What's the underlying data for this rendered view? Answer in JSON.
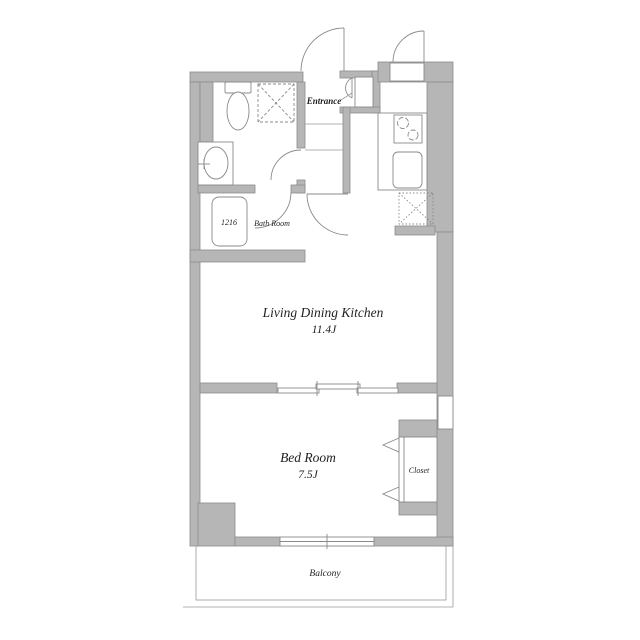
{
  "floorplan": {
    "rooms": {
      "entrance": {
        "label": "Entrance"
      },
      "bath": {
        "label": "Bath Room",
        "tub_label": "1216"
      },
      "ldk": {
        "label": "Living Dining Kitchen",
        "size": "11.4J"
      },
      "bedroom": {
        "label": "Bed Room",
        "size": "7.5J"
      },
      "closet": {
        "label": "Closet"
      },
      "balcony": {
        "label": "Balcony"
      }
    },
    "fixtures": [
      "toilet",
      "washing-machine-space",
      "washbasin",
      "bathtub",
      "stove",
      "kitchen-sink",
      "refrigerator-space",
      "shoe-cabinet",
      "meter-box",
      "pipe-space"
    ],
    "colors": {
      "wall_fill": "#b6b6b6",
      "wall_stroke": "#8c8c8c",
      "line": "#8a8a8a",
      "text": "#1f1f1f",
      "background": "#ffffff"
    }
  }
}
